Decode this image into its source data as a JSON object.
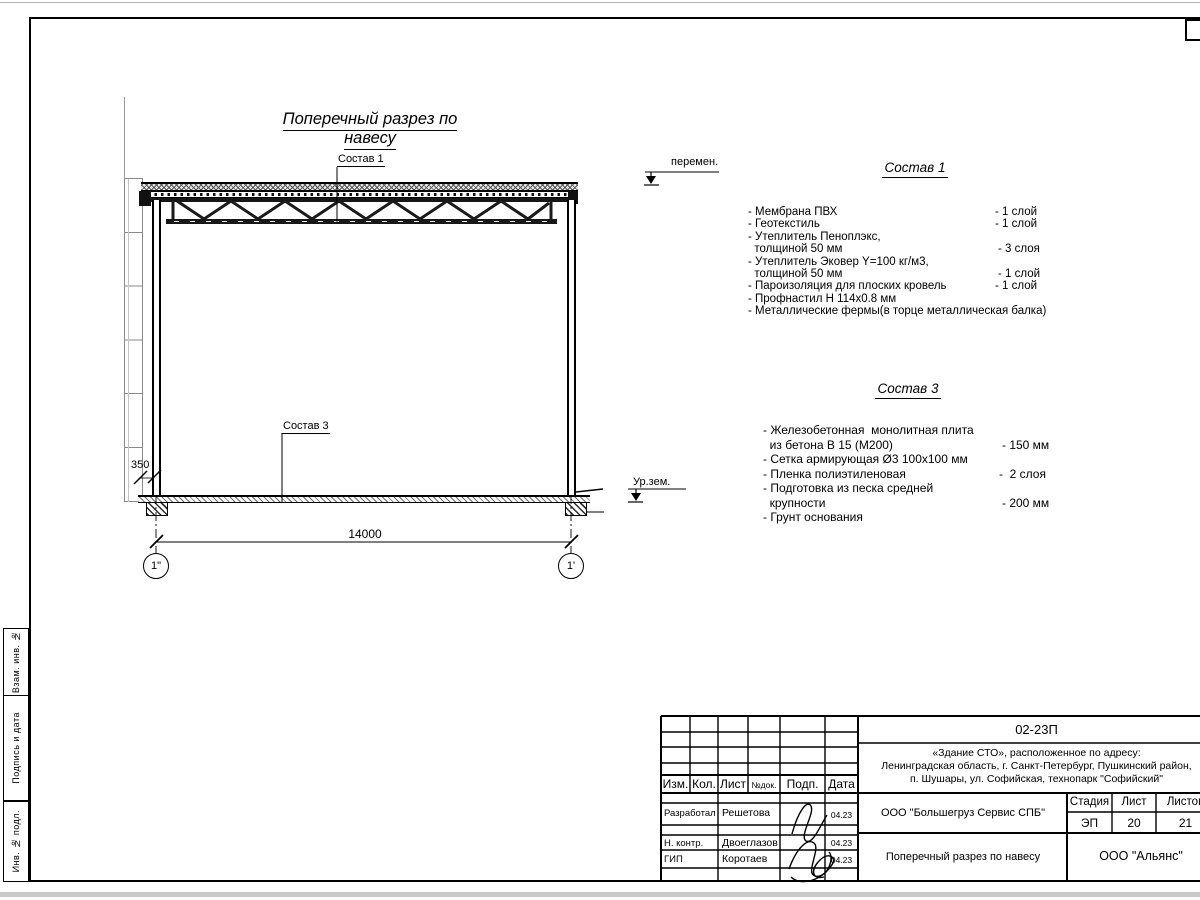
{
  "page": {
    "margin_labels": [
      "Взам. инв. №",
      "Подпись и дата",
      "Инв. № подл."
    ]
  },
  "drawing": {
    "title": "Поперечный разрез по навесу",
    "callout_sostav1": "Состав 1",
    "callout_sostav3": "Состав 3",
    "level_peremen": "перемен.",
    "level_ground": "Ур.зем.",
    "dim_offset": "350",
    "dim_span": "14000",
    "axis_left": "1\"",
    "axis_right": "1'"
  },
  "comp1": {
    "title": "Состав 1",
    "items": [
      {
        "name": "- Мембрана ПВХ",
        "qty": "- 1 слой"
      },
      {
        "name": "- Геотекстиль",
        "qty": "- 1 слой"
      },
      {
        "name": "- Утеплитель Пеноплэкс,",
        "qty": ""
      },
      {
        "name": "  толщиной 50 мм",
        "qty": "- 3 слоя"
      },
      {
        "name": "- Утеплитель Эковер Y=100 кг/м3,",
        "qty": ""
      },
      {
        "name": "  толщиной 50 мм",
        "qty": "- 1 слой"
      },
      {
        "name": "- Пароизоляция для плоских кровель",
        "qty": "- 1 слой"
      },
      {
        "name": "- Профнастил Н 114х0.8 мм",
        "qty": ""
      },
      {
        "name": "- Металлические фермы(в торце металлическая балка)",
        "qty": ""
      }
    ]
  },
  "comp3": {
    "title": "Состав 3",
    "items": [
      {
        "name": "- Железобетонная  монолитная плита",
        "qty": ""
      },
      {
        "name": "  из бетона В 15 (М200)",
        "qty": "- 150 мм"
      },
      {
        "name": "- Сетка армирующая Ø3 100х100 мм",
        "qty": ""
      },
      {
        "name": "- Пленка полиэтиленовая",
        "qty": "-  2 слоя"
      },
      {
        "name": "- Подготовка из песка средней",
        "qty": ""
      },
      {
        "name": "  крупности",
        "qty": "- 200 мм"
      },
      {
        "name": "- Грунт основания",
        "qty": ""
      }
    ]
  },
  "title_block": {
    "doc_code": "02-23П",
    "address_line1": "«Здание СТО», расположенное по адресу:",
    "address_line2": "Ленинградская область, г. Санкт-Петербург, Пушкинский район,",
    "address_line3": "п. Шушары, ул. Софийская, технопарк \"Софийский\"",
    "col_izm": "Изм.",
    "col_kol": "Кол.",
    "col_list": "Лист",
    "col_ndok": "№док.",
    "col_podp": "Подп.",
    "col_data": "Дата",
    "rows": [
      {
        "role": "Разработал",
        "name": "Решетова",
        "date": "04.23"
      },
      {
        "role": "Н. контр.",
        "name": "Двоеглазов",
        "date": "04.23"
      },
      {
        "role": "ГИП",
        "name": "Коротаев",
        "date": "04.23"
      }
    ],
    "contractor": "ООО \"Большегруз Сервис СПБ\"",
    "stage_label": "Стадия",
    "sheet_label": "Лист",
    "sheets_label": "Листов",
    "stage": "ЭП",
    "sheet": "20",
    "sheets": "21",
    "drawing_name": "Поперечный разрез по навесу",
    "designer": "ООО \"Альянс\""
  }
}
